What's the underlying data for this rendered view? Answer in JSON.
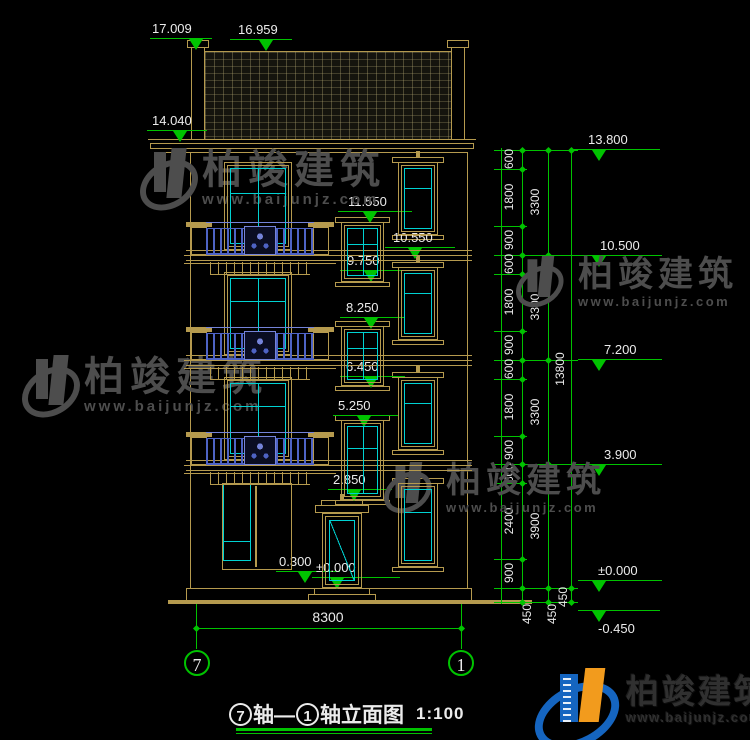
{
  "levels": {
    "l17009": "17.009",
    "l16959": "16.959",
    "l14040": "14.040",
    "l11550": "11.550",
    "l10550": "10.550",
    "l9750": "9.750",
    "l8250": "8.250",
    "l6450": "6.450",
    "l5250": "5.250",
    "l2850": "2.850",
    "l0300": "0.300",
    "l0000": "±0.000",
    "r13800": "13.800",
    "r10500": "10.500",
    "r7200": "7.200",
    "r3900": "3.900",
    "r0000": "±0.000",
    "rm0450": "-0.450"
  },
  "dims": {
    "chain_a": [
      "600",
      "1800",
      "900",
      "600",
      "1800",
      "900",
      "600",
      "1800",
      "900",
      "600",
      "2400",
      "900"
    ],
    "chain_b": [
      "3300",
      "3300",
      "3300",
      "3900"
    ],
    "chain_c": [
      "13800"
    ],
    "chain_450": [
      "450",
      "450",
      "450"
    ],
    "bottom": "8300"
  },
  "axes": {
    "left": "7",
    "right": "1"
  },
  "title": {
    "axis_from": "7",
    "joiner": "轴—",
    "axis_to": "1",
    "name": "轴立面图",
    "scale": "1:100"
  },
  "watermark": {
    "brand": "柏竣建筑",
    "url": "www.baijunjz.com"
  },
  "footer_logo": {
    "brand": "柏竣建筑",
    "url": "www.baijunjz.com"
  },
  "colors": {
    "line_tan": "#b59a4e",
    "window_cyan": "#00d2d2",
    "dimension_green": "#00c300",
    "railing_blue": "#4e63c4",
    "text_white": "#ebebeb",
    "watermark_gray": "#4d4d4d",
    "logo_blue": "#1565c0",
    "logo_orange": "#f29b1d",
    "background": "#000000"
  }
}
